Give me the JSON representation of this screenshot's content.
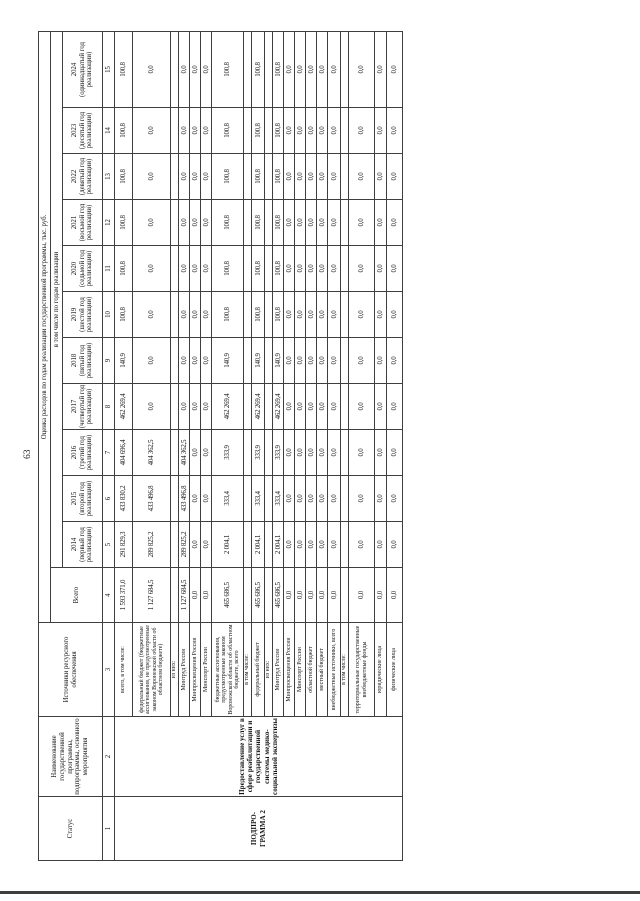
{
  "page": {
    "number": "63"
  },
  "table": {
    "headers": {
      "status": "Статус",
      "name": "Наименование государственной программы, подпрограммы, основного мероприятия",
      "sources": "Источники ресурсного обеспечения",
      "expenses": "Оценка расходов по годам реализации государственной программы, тыс. руб.",
      "including_years": "в том числе по годам реализации",
      "total": "Всего",
      "years": [
        "2014 (первый год реализации)",
        "2015 (второй год реализации)",
        "2016 (третий год реализации)",
        "2017 (четвертый год реализации)",
        "2018 (пятый год реализации)",
        "2019 (шестой год реализации)",
        "2020 (седьмой год реализации)",
        "2021 (восьмой год реализации)",
        "2022 (девятый год реализации)",
        "2023 (десятый год реализации)",
        "2024 (одиннадцатый год реализации)"
      ],
      "column_numbers": [
        "1",
        "2",
        "3",
        "4",
        "5",
        "6",
        "7",
        "8",
        "9",
        "10",
        "11",
        "12",
        "13",
        "14",
        "15"
      ]
    },
    "status_value": "ПОДПРО-ГРАММА 2",
    "program_name": "Предоставление услуг в сфере реабилитации и государственной системы медико-социальной экспертизы",
    "rows": [
      {
        "label": "всего, в том числе:",
        "values": [
          "1 593 371,0",
          "291 829,3",
          "433 830,2",
          "404 696,4",
          "462 269,4",
          "140,9",
          "100,8",
          "100,8",
          "100,8",
          "100,8",
          "100,8",
          "100,8"
        ]
      },
      {
        "label": "федеральный бюджет (бюджетные ассигнования, не предусмотренные законом Воронежской области об областном бюджете)",
        "values": [
          "1 127 684,5",
          "289 825,2",
          "433 496,8",
          "404 362,5",
          "0,0",
          "0,0",
          "0,0",
          "0,0",
          "0,0",
          "0,0",
          "0,0",
          "0,0"
        ]
      },
      {
        "label": "из них:",
        "values": []
      },
      {
        "label": "Минтруд России",
        "values": [
          "1 127 684,5",
          "289 825,2",
          "433 496,8",
          "404 362,5",
          "0,0",
          "0,0",
          "0,0",
          "0,0",
          "0,0",
          "0,0",
          "0,0",
          "0,0"
        ]
      },
      {
        "label": "Минпросвещения России",
        "values": [
          "0,0",
          "0,0",
          "0,0",
          "0,0",
          "0,0",
          "0,0",
          "0,0",
          "0,0",
          "0,0",
          "0,0",
          "0,0",
          "0,0"
        ]
      },
      {
        "label": "Минспорт России",
        "values": [
          "0,0",
          "0,0",
          "0,0",
          "0,0",
          "0,0",
          "0,0",
          "0,0",
          "0,0",
          "0,0",
          "0,0",
          "0,0",
          "0,0"
        ]
      },
      {
        "label": "бюджетные ассигнования, предусмотренные законом Воронежской области об областном бюджете, всего",
        "values": [
          "465 686,5",
          "2 004,1",
          "333,4",
          "333,9",
          "462 269,4",
          "140,9",
          "100,8",
          "100,8",
          "100,8",
          "100,8",
          "100,8",
          "100,8"
        ]
      },
      {
        "label": "в том числе:",
        "values": []
      },
      {
        "label": "федеральный бюджет",
        "values": [
          "465 686,5",
          "2 004,1",
          "333,4",
          "333,9",
          "462 269,4",
          "140,9",
          "100,8",
          "100,8",
          "100,8",
          "100,8",
          "100,8",
          "100,8"
        ]
      },
      {
        "label": "из них:",
        "values": []
      },
      {
        "label": "Минтруд России",
        "values": [
          "465 686,5",
          "2 004,1",
          "333,4",
          "333,9",
          "462 269,4",
          "140,9",
          "100,8",
          "100,8",
          "100,8",
          "100,8",
          "100,8",
          "100,8"
        ]
      },
      {
        "label": "Минпросвещения России",
        "values": [
          "0,0",
          "0,0",
          "0,0",
          "0,0",
          "0,0",
          "0,0",
          "0,0",
          "0,0",
          "0,0",
          "0,0",
          "0,0",
          "0,0"
        ]
      },
      {
        "label": "Минспорт России",
        "values": [
          "0,0",
          "0,0",
          "0,0",
          "0,0",
          "0,0",
          "0,0",
          "0,0",
          "0,0",
          "0,0",
          "0,0",
          "0,0",
          "0,0"
        ]
      },
      {
        "label": "областной бюджет",
        "values": [
          "0,0",
          "0,0",
          "0,0",
          "0,0",
          "0,0",
          "0,0",
          "0,0",
          "0,0",
          "0,0",
          "0,0",
          "0,0",
          "0,0"
        ]
      },
      {
        "label": "местный бюджет",
        "values": [
          "0,0",
          "0,0",
          "0,0",
          "0,0",
          "0,0",
          "0,0",
          "0,0",
          "0,0",
          "0,0",
          "0,0",
          "0,0",
          "0,0"
        ]
      },
      {
        "label": "внебюджетные источники, всего",
        "values": [
          "0,0",
          "0,0",
          "0,0",
          "0,0",
          "0,0",
          "0,0",
          "0,0",
          "0,0",
          "0,0",
          "0,0",
          "0,0",
          "0,0"
        ]
      },
      {
        "label": "в том числе:",
        "values": []
      },
      {
        "label": "территориальные государственные внебюджетные фонды",
        "values": [
          "0,0",
          "0,0",
          "0,0",
          "0,0",
          "0,0",
          "0,0",
          "0,0",
          "0,0",
          "0,0",
          "0,0",
          "0,0",
          "0,0"
        ]
      },
      {
        "label": "юридические лица",
        "values": [
          "0,0",
          "0,0",
          "0,0",
          "0,0",
          "0,0",
          "0,0",
          "0,0",
          "0,0",
          "0,0",
          "0,0",
          "0,0",
          "0,0"
        ]
      },
      {
        "label": "физические лица",
        "values": [
          "0,0",
          "0,0",
          "0,0",
          "0,0",
          "0,0",
          "0,0",
          "0,0",
          "0,0",
          "0,0",
          "0,0",
          "0,0",
          "0,0"
        ]
      }
    ]
  }
}
